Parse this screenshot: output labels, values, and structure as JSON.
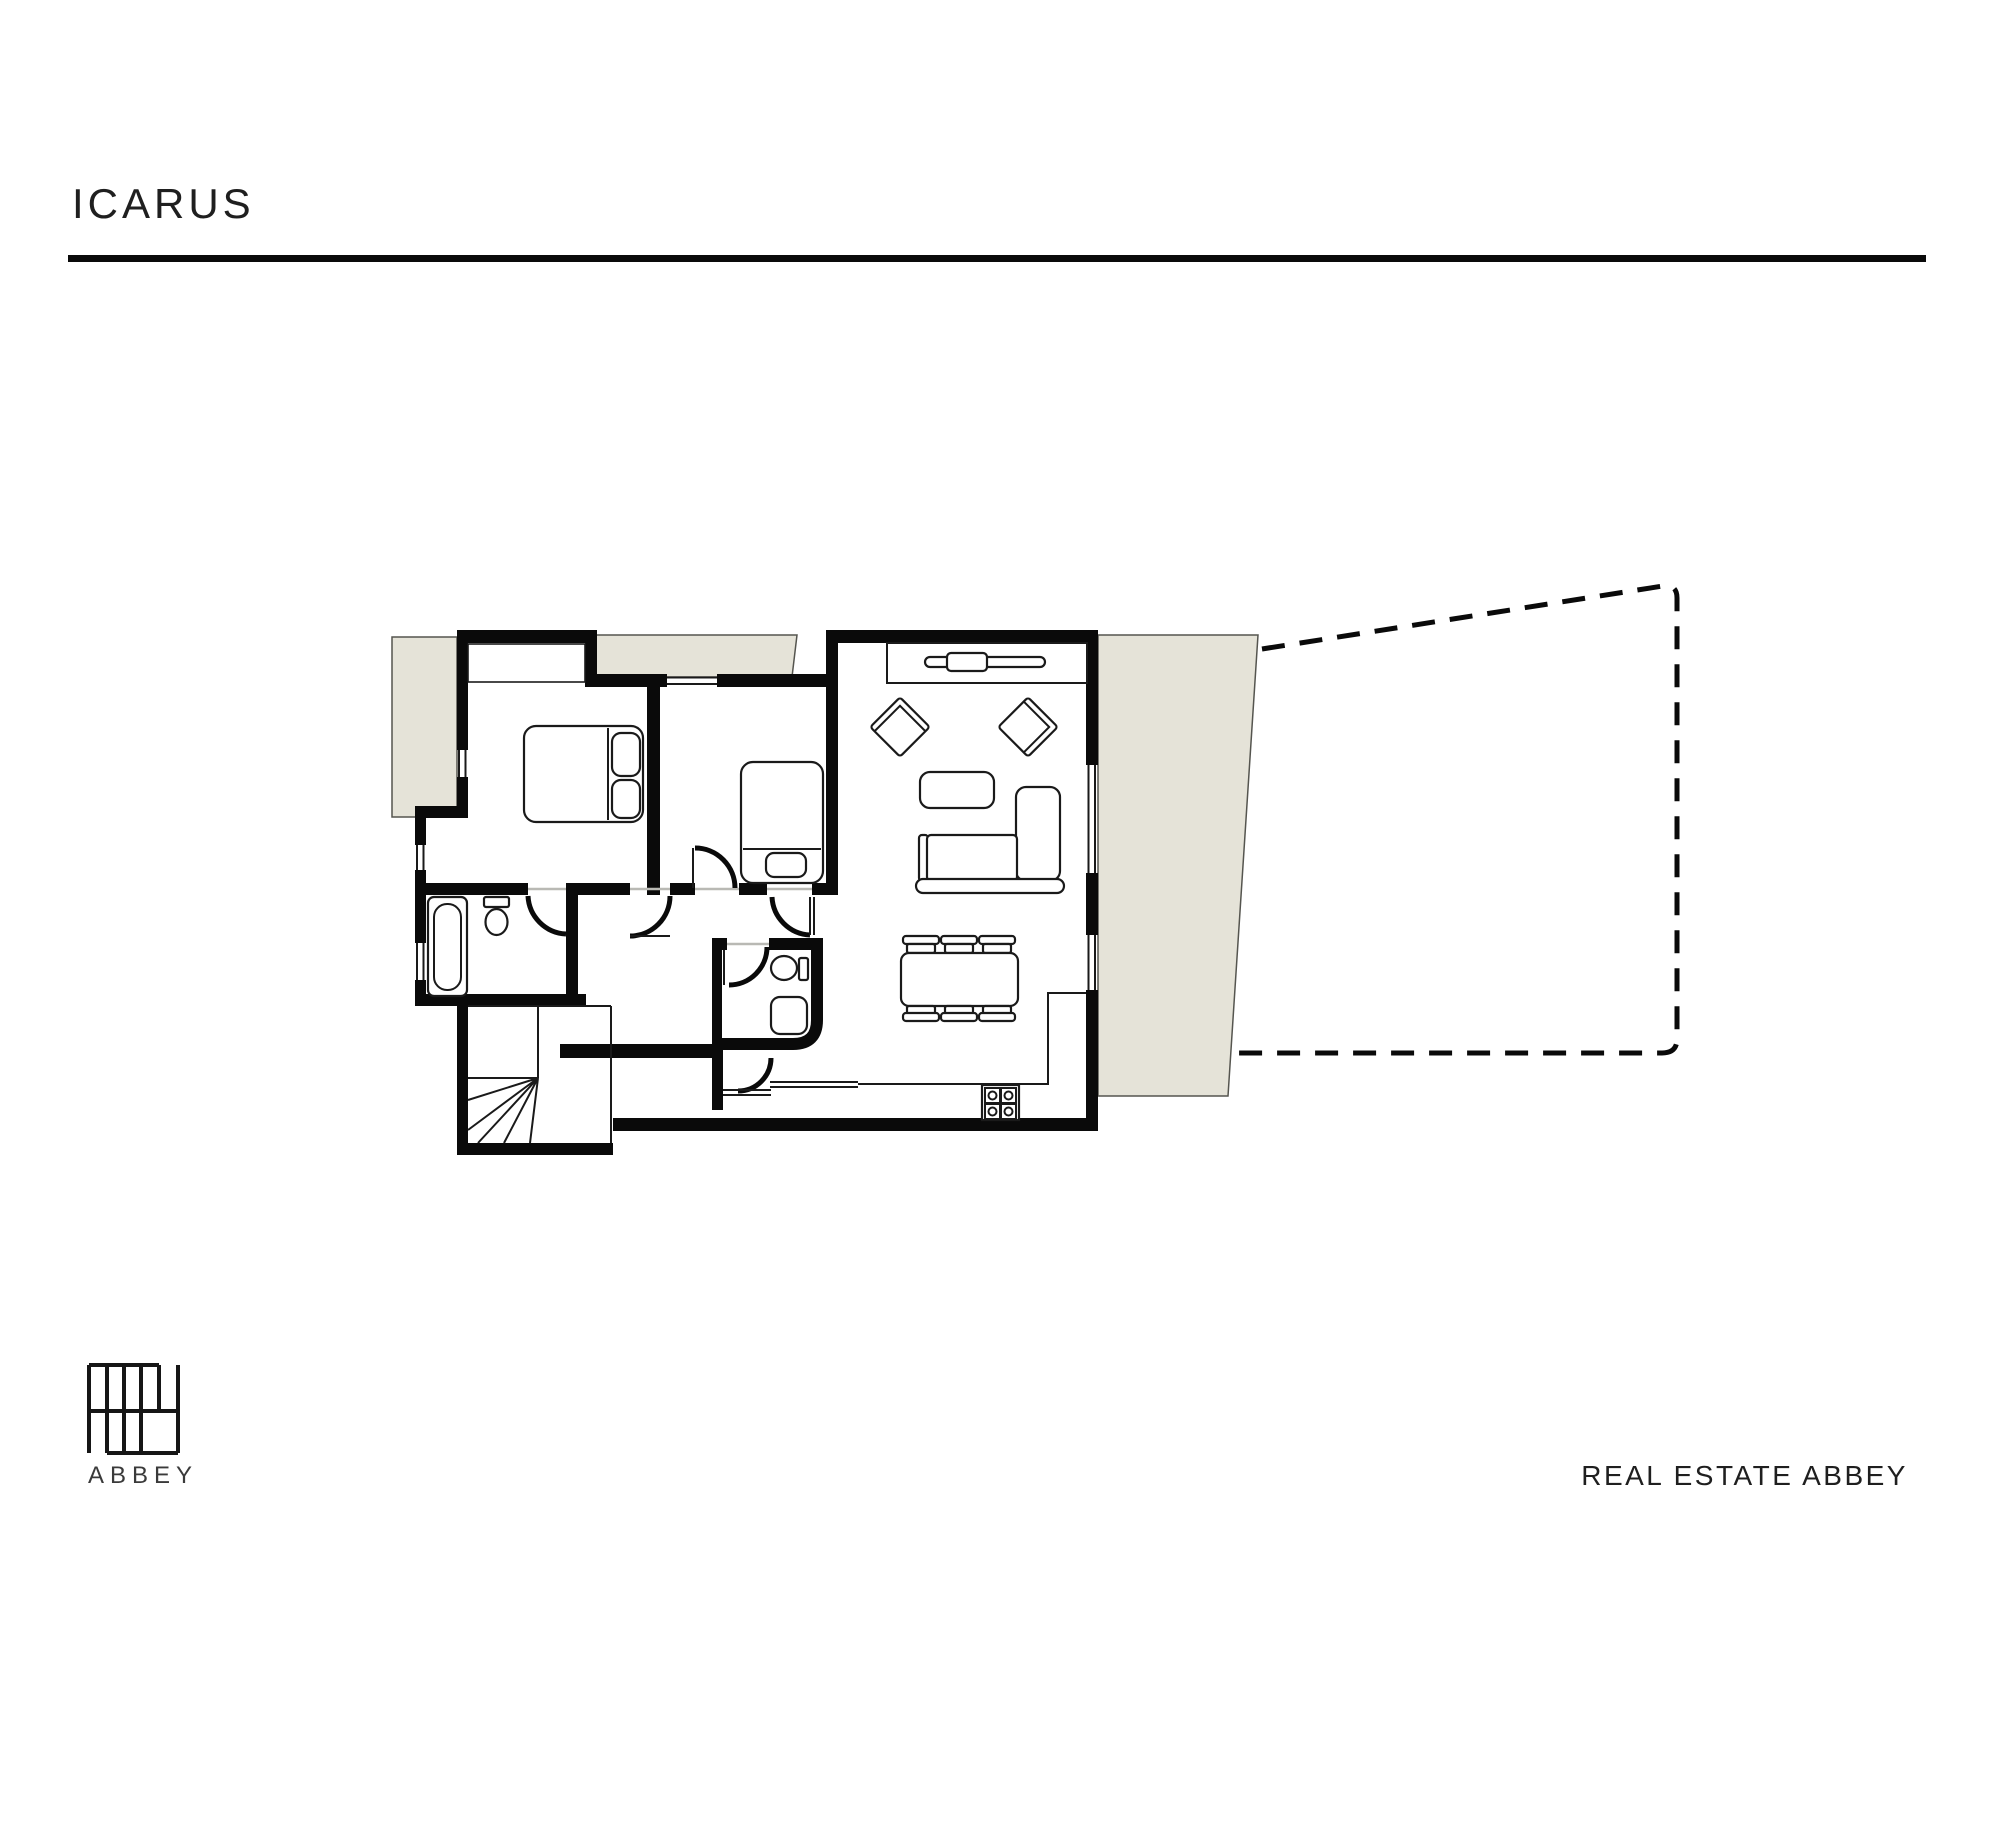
{
  "header": {
    "title": "ICARUS"
  },
  "footer": {
    "brand": "REAL ESTATE ABBEY"
  },
  "logo": {
    "label": "ABBEY",
    "icon": "brick-grid-logo"
  },
  "floor_plan": {
    "type": "apartment-floor-plan",
    "rooms": [
      "bedroom-1",
      "bedroom-2",
      "bathroom",
      "wc",
      "hallway",
      "stairwell",
      "living-dining-kitchen"
    ],
    "furniture": [
      "double-bed",
      "single-bed",
      "wardrobe",
      "bathtub",
      "toilet",
      "wc-sink",
      "wc-toilet",
      "tv-console",
      "armchair",
      "armchair",
      "coffee-table",
      "sofa",
      "dining-table",
      "dining-chairs-x6",
      "stove",
      "kitchen-counter",
      "winder-stairs"
    ],
    "outdoor": [
      "balcony-left",
      "balcony-top",
      "terrace-right",
      "dashed-property-boundary"
    ]
  },
  "colors": {
    "background": "#ffffff",
    "wall": "#0a0a0a",
    "line": "#1a1a1a",
    "beige": "#e5e3d8",
    "text": "#1f1f1f",
    "muted": "#3a3a3a"
  }
}
